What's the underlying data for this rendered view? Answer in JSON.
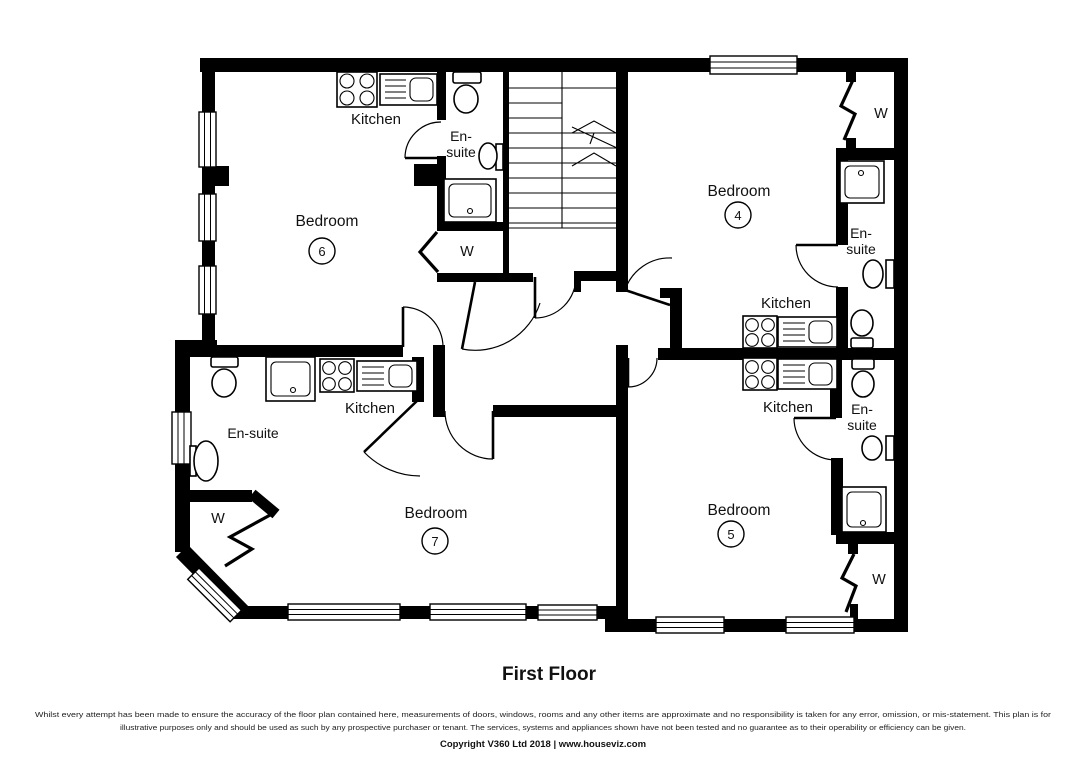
{
  "plan": {
    "title": "First Floor",
    "units": {
      "bedroom6": {
        "room": "Bedroom",
        "number": "6",
        "kitchen": "Kitchen",
        "ensuite_line1": "En-",
        "ensuite_line2": "suite",
        "wardrobe": "W"
      },
      "bedroom4": {
        "room": "Bedroom",
        "number": "4",
        "kitchen": "Kitchen",
        "ensuite_line1": "En-",
        "ensuite_line2": "suite",
        "wardrobe": "W"
      },
      "bedroom7": {
        "room": "Bedroom",
        "number": "7",
        "kitchen": "Kitchen",
        "ensuite": "En-suite",
        "wardrobe": "W"
      },
      "bedroom5": {
        "room": "Bedroom",
        "number": "5",
        "kitchen": "Kitchen",
        "ensuite_line1": "En-",
        "ensuite_line2": "suite",
        "wardrobe": "W"
      }
    }
  },
  "footer": {
    "disclaimer_line1": "Whilst every attempt has been made to ensure the accuracy of the floor plan contained here, measurements of doors, windows, rooms and any other items are approximate and no responsibility is taken for any error, omission, or mis-statement. This plan is for",
    "disclaimer_line2": "illustrative purposes only and should be used as such by any prospective purchaser or tenant. The services, systems and appliances shown have not been tested and no guarantee as to their operability or efficiency can be given.",
    "copyright": "Copyright V360 Ltd 2018 | www.houseviz.com"
  },
  "colors": {
    "wall": "#000000",
    "background": "#ffffff",
    "text": "#111111"
  }
}
